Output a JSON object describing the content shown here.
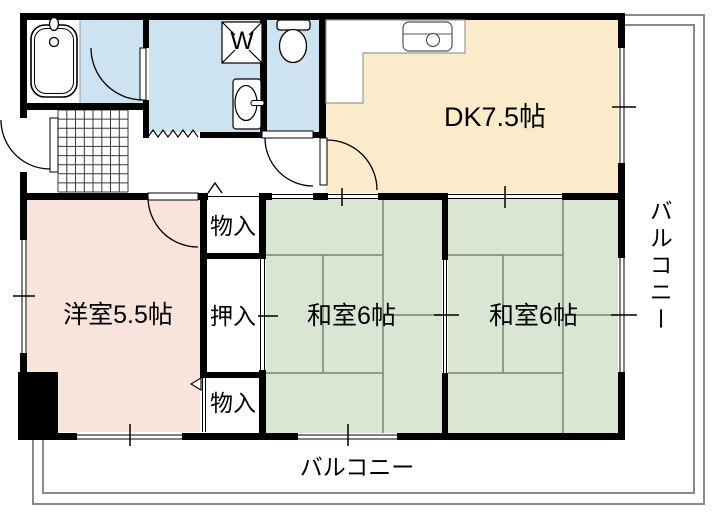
{
  "floorplan": {
    "rooms": {
      "dining_kitchen": {
        "label": "DK7.5帖",
        "size_tatami": "7.5"
      },
      "western_room": {
        "label": "洋室5.5帖",
        "size_tatami": "5.5"
      },
      "japanese_room_1": {
        "label": "和室6帖",
        "size_tatami": "6"
      },
      "japanese_room_2": {
        "label": "和室6帖",
        "size_tatami": "6"
      },
      "storage_top": {
        "label": "物入"
      },
      "closet": {
        "label": "押入"
      },
      "storage_bottom": {
        "label": "物入"
      },
      "washer_pan": {
        "label": "W"
      }
    },
    "balconies": {
      "bottom": {
        "label": "バルコニー"
      },
      "right": {
        "label": "バルコニー"
      }
    },
    "colors": {
      "wet_area": "#cde3f2",
      "dk": "#fcebca",
      "western": "#f9e4db",
      "tatami": "#d9e6d3",
      "wall": "#000000",
      "balcony_rail": "#8a8a8a",
      "tatami_line": "#75856f"
    }
  }
}
